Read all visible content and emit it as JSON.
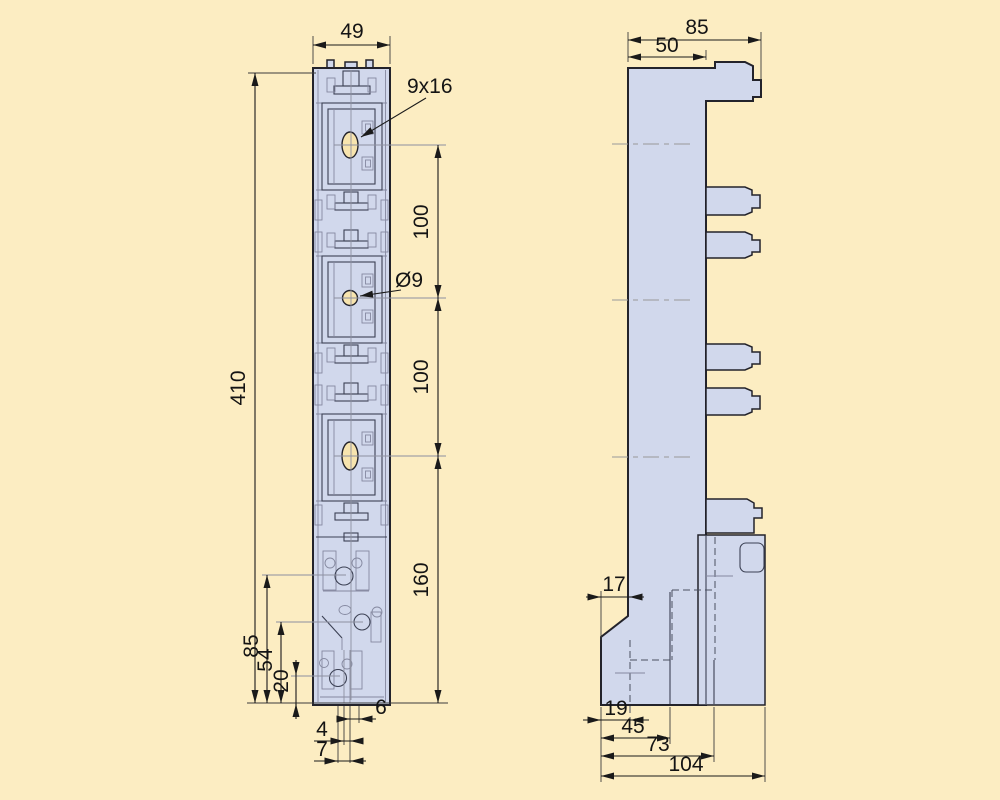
{
  "colors": {
    "background": "#FCEDC2",
    "part_fill": "#D1D8EC",
    "outline": "#23232B",
    "dimension_line": "#1A1A1A",
    "centerline": "#999999",
    "hole_fill": "#F7E4AE"
  },
  "front_view": {
    "width": "49",
    "slot_label": "9x16",
    "hole_label": "Ø9",
    "pitch_top": "100",
    "pitch_bottom": "100",
    "lower_section": "160",
    "overall_height": "410",
    "base_85": "85",
    "base_54": "54",
    "base_20": "20",
    "slot_6": "6",
    "slot_4": "4",
    "slot_7": "7"
  },
  "side_view": {
    "overall_depth": "85",
    "body_depth": "50",
    "foot_offset": "17",
    "base_19": "19",
    "base_45": "45",
    "base_73": "73",
    "base_104": "104"
  }
}
